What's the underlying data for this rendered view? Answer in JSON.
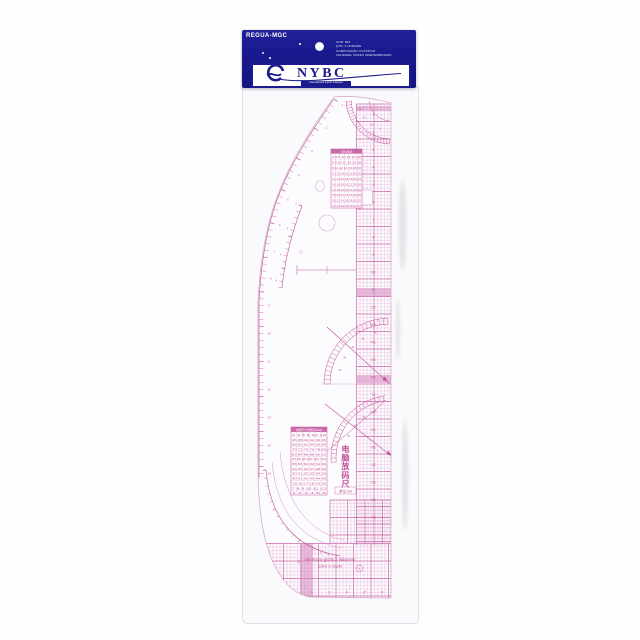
{
  "colors": {
    "navy": "#1c1c8e",
    "pink": "#c0519a",
    "pink_soft": "#d98fc3",
    "pink_pale": "#efc9e2",
    "band": "#d689bf",
    "outline": "#d9b6cd"
  },
  "header_card": {
    "sku": "REGUA-MGC",
    "info_lines": [
      "COR: MIX",
      "QTD: 1 UNIDADE",
      "COMPOSIÇÃO: PLÁSTICO",
      "VALIDADE: PRAZO INDETERMINADO"
    ],
    "brand": "NYBC",
    "tagline": "Internacional Import & Export"
  },
  "ruler": {
    "vertical_title": "电脑放码尺",
    "unit_label": "单位:CM",
    "bottom_line1": "Versatile Cutting-out Ruler",
    "bottom_line2": "Made in china",
    "corner_mark": "1",
    "circled_mark": "4",
    "upper_table": {
      "title": "尺码对照表",
      "rows": [
        "4 6 8 10 12 14 16",
        "6 8 10 12 14 16 18",
        "8 10 12 14 16 18 20",
        "10 12 14 16 18 20 22",
        "12 14 16 18 20 22 24",
        "14 16 18 20 22 24 26",
        "16 18 20 22 24 26 28",
        "18 20 22 24 26 28 30",
        "20 22 24 26 28 30 32",
        "22 24 26 28 30 32 34"
      ]
    },
    "lower_table": {
      "title": "常用尺寸对照表(CM)",
      "rows": [
        "2 4 6 8 10 12",
        "36 38 40 42 44 46",
        "58 60 62 64 66 68",
        "70 72 74 76 78 80",
        "82 84 86 88 90 92",
        "94 96 98 100 102 104",
        "56 58 60 62 64 66",
        "24 25 26 27 28 29",
        "30 31 32 33 34 35",
        "40 41 42 43 44 45",
        "15 16 17 18 19 20",
        "7 8 9 10 11 12",
        "1 2 3 4 5 6"
      ]
    },
    "scales": {
      "right": [
        "1",
        "2",
        "3",
        "4",
        "5",
        "6",
        "7",
        "8",
        "9",
        "10",
        "11",
        "12",
        "13",
        "14",
        "15",
        "16",
        "17",
        "18",
        "19",
        "20",
        "21",
        "22",
        "23",
        "24"
      ],
      "bottom": [
        "0",
        "1",
        "2",
        "3",
        "4",
        "5",
        "6"
      ],
      "left_curve": [
        "1",
        "2",
        "3",
        "4",
        "5",
        "6",
        "7",
        "8",
        "9",
        "10",
        "11",
        "12",
        "13",
        "14",
        "15",
        "16"
      ],
      "inner_curve": [
        "2",
        "4",
        "6",
        "8"
      ],
      "fan_top": [
        "5",
        "10",
        "15",
        "20"
      ],
      "fan_mid": [
        "15",
        "30",
        "45",
        "60",
        "75"
      ],
      "fan_low": [
        "15",
        "30",
        "45",
        "60",
        "75"
      ]
    }
  }
}
